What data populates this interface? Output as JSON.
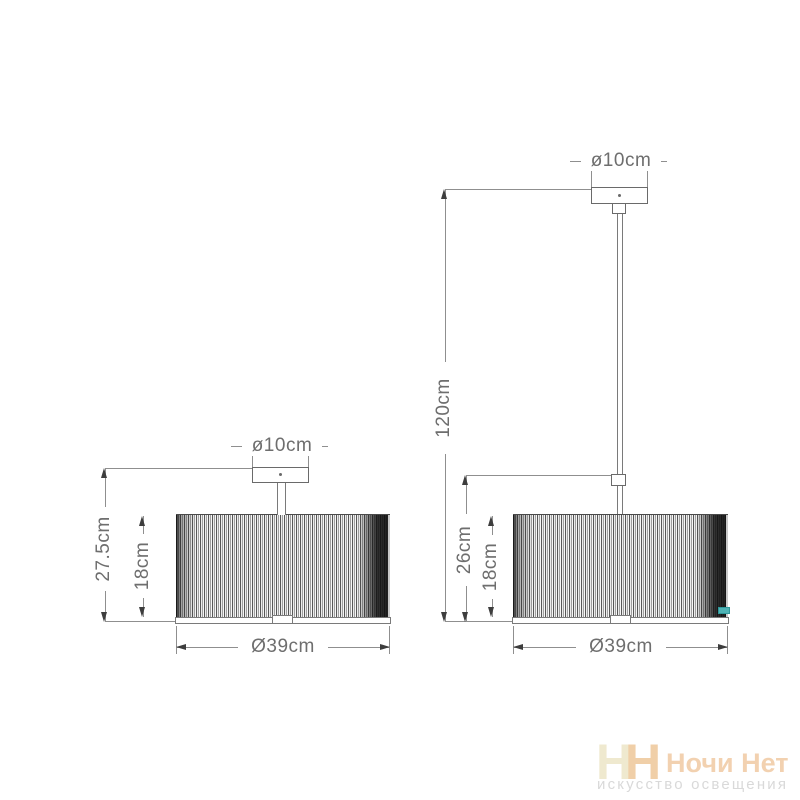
{
  "diagram": {
    "left_lamp": {
      "canopy_diameter_label": "ø10cm",
      "total_height_label": "27.5cm",
      "shade_height_label": "18cm",
      "shade_diameter_label": "Ø39cm"
    },
    "right_lamp": {
      "canopy_diameter_label": "ø10cm",
      "total_height_label": "120cm",
      "suspension_height_label": "26cm",
      "shade_height_label": "18cm",
      "shade_diameter_label": "Ø39cm",
      "shade_tag_color": "#4fb4b6"
    },
    "line_color": "#8f8f8f",
    "text_color": "#6e6e6e"
  },
  "watermark": {
    "monogram_left": "Н",
    "monogram_right": "Н",
    "brand_name": "Ночи Нет",
    "tagline": "искусство освещения",
    "monogram_left_color": "#efe9cf",
    "monogram_right_color": "#f0cfa8",
    "brand_color": "#f2d1b0",
    "tagline_color": "#d9d9d9"
  }
}
